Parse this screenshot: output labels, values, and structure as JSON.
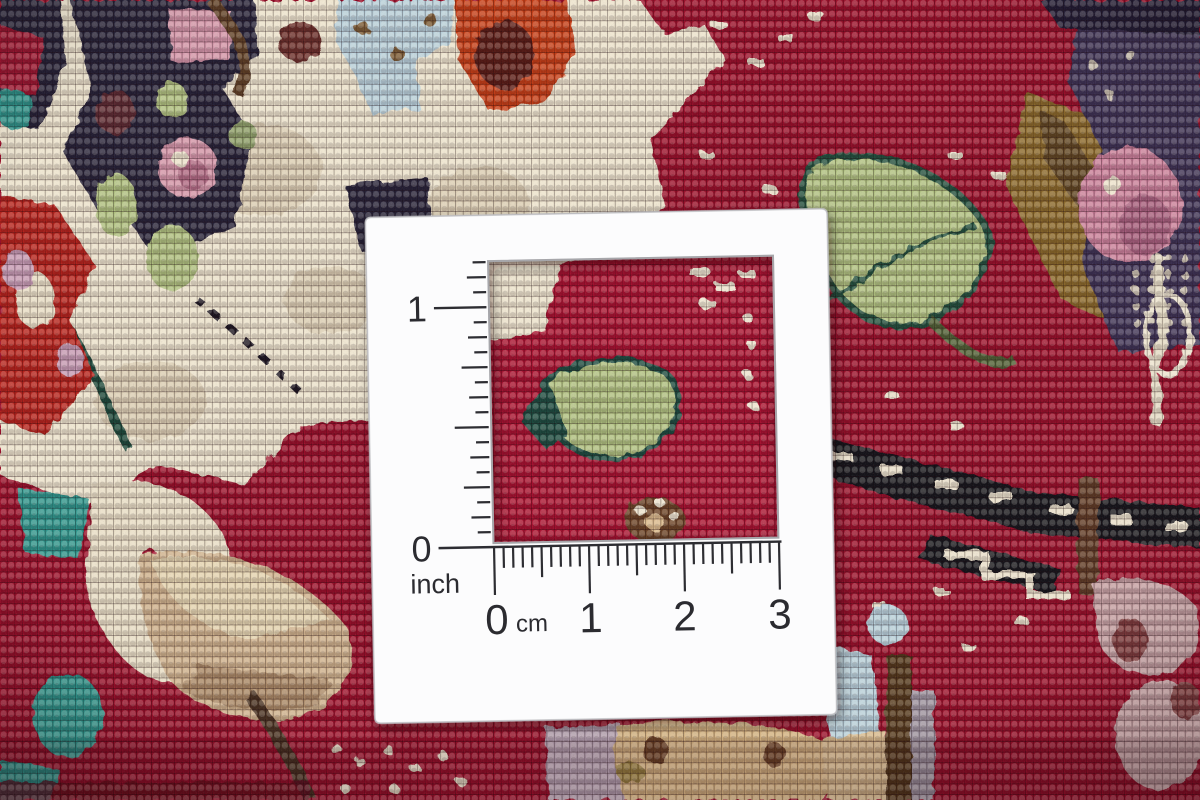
{
  "scene": {
    "subject": "Close-up photograph of a hand-knotted red oriental carpet with a white measuring card laid on it; the card has a square cutout window revealing the knots"
  },
  "measure_card": {
    "inch_ruler": {
      "label_1": "1",
      "label_0": "0",
      "unit": "inch"
    },
    "cm_ruler": {
      "label_0": "0",
      "unit": "cm",
      "label_1": "1",
      "label_2": "2",
      "label_3": "3"
    }
  },
  "palette": {
    "field_red": "#9a0f2a",
    "window_red": "#a81130",
    "cream": "#ebe2cc",
    "navy": "#262038",
    "pink": "#d294a8",
    "light_green": "#aebf7f",
    "dark_green": "#1d4a3a",
    "teal": "#2f958c",
    "orange": "#c43d17",
    "olive": "#8a682b",
    "brown": "#5f3f28",
    "light_blue": "#b7cfda",
    "tan": "#cdb08c",
    "gold_tan": "#d2b180",
    "lilac": "#b3a0b0",
    "purple": "#3e3354",
    "rose": "#c97f9a",
    "rose_taupe": "#c49fa2",
    "black_band": "#15121c",
    "card_white": "#fcfcfd",
    "ink": "#2d2d32"
  }
}
